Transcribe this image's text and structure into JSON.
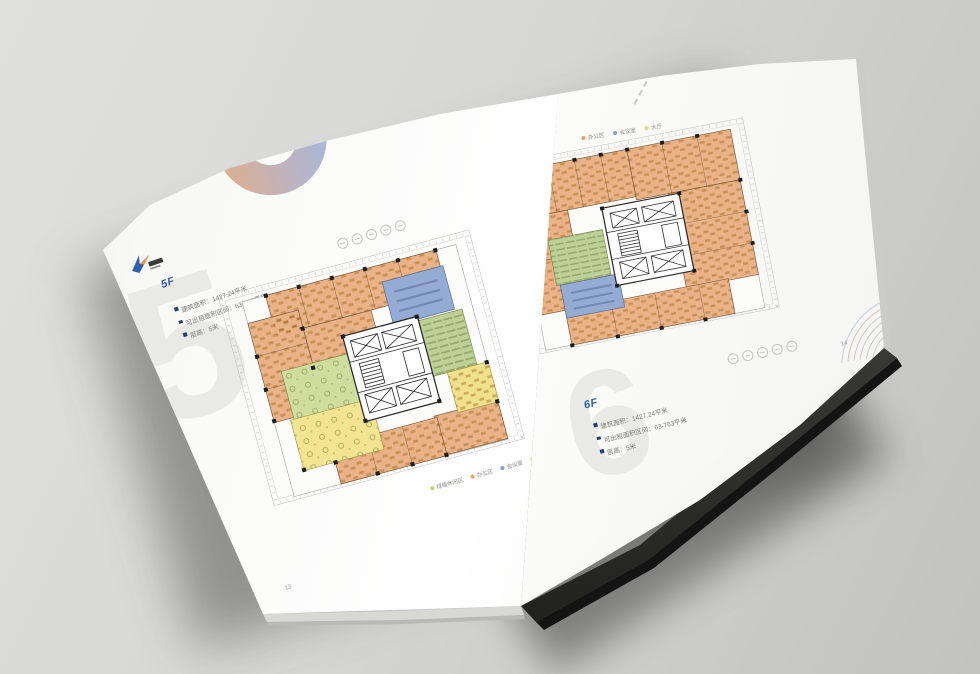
{
  "scene": {
    "background_colors": [
      "#e0e0de",
      "#c2c2c0"
    ],
    "subject": "open brochure spread with floor plans"
  },
  "pages": {
    "left": {
      "floor_label": "5F",
      "info_items": [
        "建筑面积：1427.24平米",
        "可出租面积区间：63-763平米",
        "层高：5米"
      ],
      "legend": [
        {
          "label": "绿植休闲区",
          "color": "#c9d36e"
        },
        {
          "label": "办公区",
          "color": "#e8a35f"
        },
        {
          "label": "会议室",
          "color": "#7f9fd0"
        },
        {
          "label": "大厅",
          "color": "#e6d96a"
        }
      ],
      "watermark": "5",
      "page_number": "13",
      "amenity_icon_count": 5
    },
    "right": {
      "floor_label": "6F",
      "info_items": [
        "建筑面积：1427.24平米",
        "可出租面积区间：63-763平米",
        "层高：5米"
      ],
      "legend": [
        {
          "label": "办公区",
          "color": "#e8a35f"
        },
        {
          "label": "会议室",
          "color": "#7f9fd0"
        },
        {
          "label": "大厅",
          "color": "#e6d96a"
        }
      ],
      "watermark": "6",
      "page_number": "14",
      "amenity_icon_count": 5
    }
  },
  "plan_colors": {
    "office_area": "#e9b287",
    "meeting_room": "#94abd4",
    "training_room": "#bdd095",
    "leisure_area": "#cfdd9e",
    "hall": "#f2e490",
    "core_lines": "#2a2a2a",
    "dimension_lines": "#b8b8b6"
  },
  "accents": {
    "floor_label_color": "#2e5fae",
    "bullet_color": "#1f3e7c",
    "ring_gradient": [
      "#d8a27c",
      "#98abd0"
    ]
  }
}
